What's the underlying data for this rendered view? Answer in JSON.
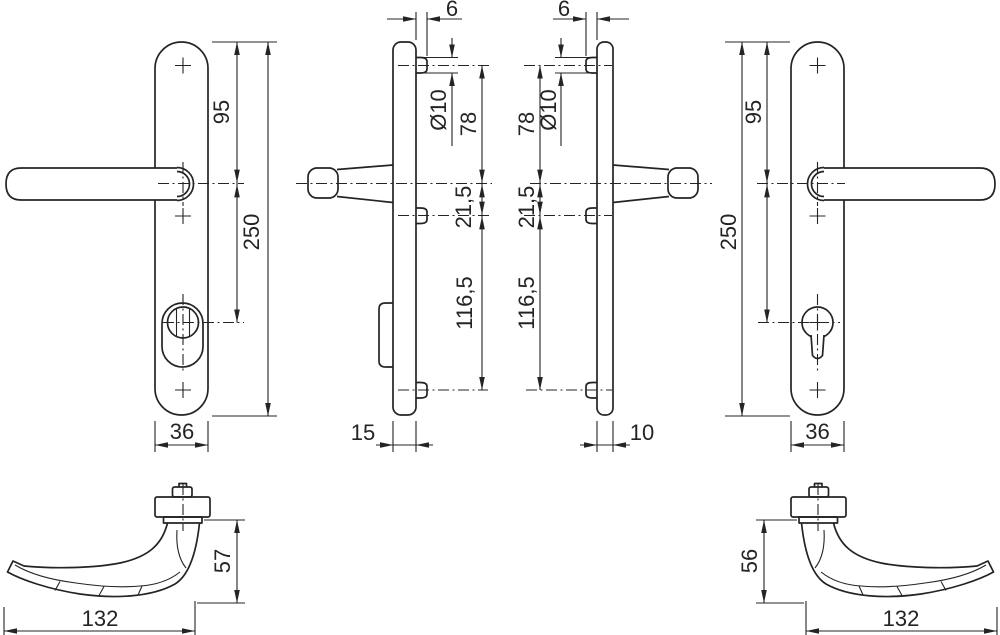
{
  "drawing": {
    "kind": "door handle fitting dimension drawing",
    "colors": {
      "line": "#242424",
      "background": "#ffffff"
    },
    "views": {
      "front_left": {
        "top_to_lever": "95",
        "plate_height": "250",
        "plate_width": "36"
      },
      "side_left": {
        "lug_projection": "6",
        "lug_diameter": "Ø10",
        "lug_to_lever": "78",
        "lever_to_lug2": "21,5",
        "lug2_to_lug3": "116,5",
        "plate_depth": "15"
      },
      "side_right": {
        "lug_projection": "6",
        "lug_diameter": "Ø10",
        "lug_to_lever": "78",
        "lever_to_lug2": "21,5",
        "lug2_to_lug3": "116,5",
        "plate_depth": "10"
      },
      "front_right": {
        "top_to_lever": "95",
        "plate_height": "250",
        "plate_width": "36"
      },
      "handle_left": {
        "handle_height": "57",
        "handle_length": "132"
      },
      "handle_right": {
        "handle_height": "56",
        "handle_length": "132"
      }
    }
  }
}
